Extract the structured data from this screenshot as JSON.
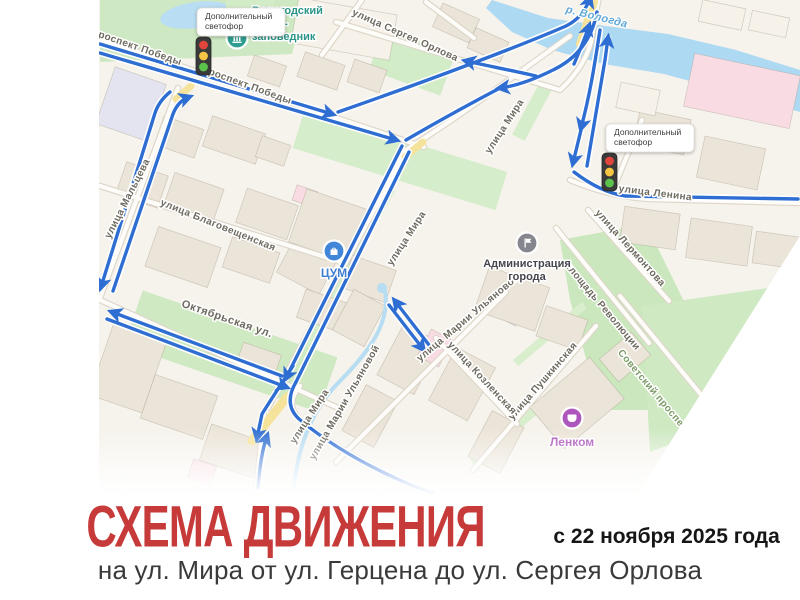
{
  "caption": {
    "title": "СХЕМА ДВИЖЕНИЯ",
    "date": "с 22 ноября 2025 года",
    "subtitle": "на ул. Мира от ул. Герцена до ул. Сергея Орлова",
    "title_color": "#c63b3a"
  },
  "map": {
    "colors": {
      "route_blue": "#2e6dd2",
      "land": "#f6f3ec",
      "green": "#d3ecc8",
      "river": "#aed9f2",
      "road": "#fdfcf9",
      "yellow_road": "#f6e39b",
      "light_red": "#e2453c",
      "light_yellow": "#f6c544",
      "light_green": "#5bc24c"
    },
    "street_labels": [
      {
        "text": "проспект Победы",
        "x": 136,
        "y": 50,
        "angle": 19,
        "type": ""
      },
      {
        "text": "проспект Победы",
        "x": 246,
        "y": 88,
        "angle": 20,
        "type": ""
      },
      {
        "text": "улица Сергея Орлова",
        "x": 404,
        "y": 38,
        "angle": 24,
        "type": ""
      },
      {
        "text": "р. Вологда",
        "x": 596,
        "y": 20,
        "angle": 14,
        "type": "river"
      },
      {
        "text": "улица Ленина",
        "x": 655,
        "y": 196,
        "angle": 7,
        "type": ""
      },
      {
        "text": "улица Лермонтова",
        "x": 628,
        "y": 250,
        "angle": 48,
        "type": ""
      },
      {
        "text": "площадь Революции",
        "x": 600,
        "y": 308,
        "angle": 50,
        "type": ""
      },
      {
        "text": "Советский проспект",
        "x": 652,
        "y": 394,
        "angle": 50,
        "type": "park"
      },
      {
        "text": "улица Пушкинская",
        "x": 545,
        "y": 383,
        "angle": -49,
        "type": ""
      },
      {
        "text": "улица Козленская",
        "x": 480,
        "y": 380,
        "angle": 47,
        "type": ""
      },
      {
        "text": "улица Марии Ульяновой",
        "x": 470,
        "y": 320,
        "angle": -40,
        "type": ""
      },
      {
        "text": "улица Марии Ульяновой",
        "x": 347,
        "y": 404,
        "angle": -60,
        "type": ""
      },
      {
        "text": "улица Мира",
        "x": 507,
        "y": 128,
        "angle": -57,
        "type": ""
      },
      {
        "text": "улица Мира",
        "x": 409,
        "y": 240,
        "angle": -57,
        "type": ""
      },
      {
        "text": "улица Мира",
        "x": 312,
        "y": 418,
        "angle": -57,
        "type": ""
      },
      {
        "text": "улица Благовещенская",
        "x": 217,
        "y": 228,
        "angle": 22,
        "type": ""
      },
      {
        "text": "Октябрьская ул.",
        "x": 226,
        "y": 322,
        "angle": 19,
        "type": "lg"
      },
      {
        "text": "улица Мальцева",
        "x": 130,
        "y": 200,
        "angle": -63,
        "type": ""
      }
    ],
    "pois": [
      {
        "id": "museum",
        "glyph": "museum",
        "color": "#2f9e90",
        "x": 237,
        "y": 38,
        "label_lines": [
          "Вологодский",
          "музей-",
          "заповедник"
        ],
        "label_color": "#2c9488",
        "label_dx": 15,
        "label_dy": -24,
        "align": "start",
        "label_size": 11
      },
      {
        "id": "tsum",
        "glyph": "bag",
        "color": "#4186d8",
        "x": 334,
        "y": 251,
        "label_lines": [
          "ЦУМ"
        ],
        "label_color": "#3f7fd1",
        "label_dx": 0,
        "label_dy": 26,
        "align": "middle",
        "label_size": 12
      },
      {
        "id": "administration",
        "glyph": "flag",
        "color": "#86868f",
        "x": 527,
        "y": 243,
        "label_lines": [
          "Администрация",
          "города"
        ],
        "label_color": "#45454d",
        "label_dx": 0,
        "label_dy": 24,
        "align": "middle",
        "label_size": 11
      },
      {
        "id": "lenkom",
        "glyph": "mask",
        "color": "#ad56bd",
        "x": 572,
        "y": 418,
        "label_lines": [
          "Ленком"
        ],
        "label_color": "#a94fb8",
        "label_dx": 0,
        "label_dy": 28,
        "align": "middle",
        "label_size": 12
      }
    ],
    "traffic_light_notes": [
      {
        "text_lines": [
          "Дополнительный",
          "светофор"
        ],
        "x": 197,
        "y": 8,
        "w": 88,
        "h": 28,
        "light_x": 196,
        "light_y": 37
      },
      {
        "text_lines": [
          "Дополнительный",
          "светофор"
        ],
        "x": 606,
        "y": 124,
        "w": 88,
        "h": 28,
        "light_x": 602,
        "light_y": 153
      }
    ]
  }
}
